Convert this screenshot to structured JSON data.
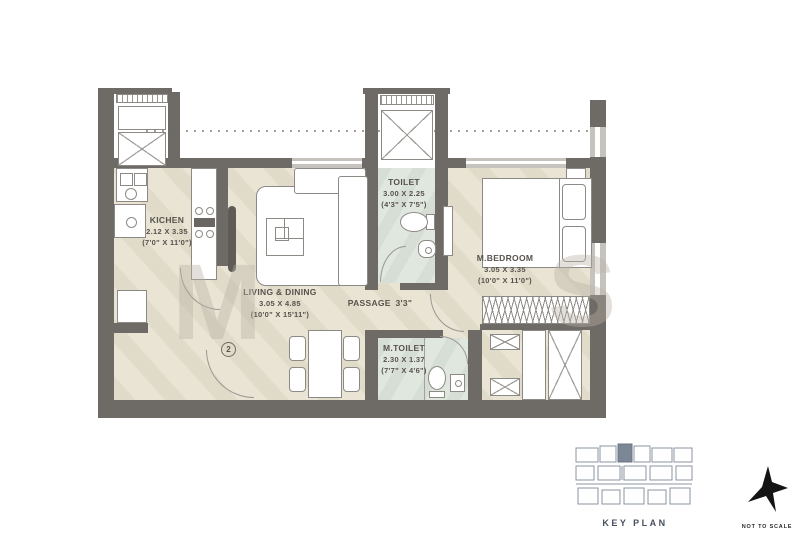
{
  "plan": {
    "rooms": {
      "kitchen": {
        "name": "KICHEN",
        "dims_m": "2.12 X 3.35",
        "dims_ft": "(7'0\" X 11'0\")"
      },
      "living_dining": {
        "name": "LIVING & DINING",
        "dims_m": "3.05 X 4.85",
        "dims_ft": "(10'0\" X 15'11\")"
      },
      "toilet": {
        "name": "TOILET",
        "dims_m": "3.00 X 2.25",
        "dims_ft": "(4'3\" X 7'5\")"
      },
      "master_bedroom": {
        "name": "M.BEDROOM",
        "dims_m": "3.05 X 3.35",
        "dims_ft": "(10'0\" X 11'0\")"
      },
      "master_toilet": {
        "name": "M.TOILET",
        "dims_m": "2.30 X 1.37",
        "dims_ft": "(7'7\" X 4'6\")"
      },
      "passage": {
        "name": "PASSAGE",
        "width": "3'3\""
      }
    },
    "door_marker": "2",
    "watermark_letters": [
      "M",
      "S"
    ]
  },
  "footer": {
    "key_plan": "KEY PLAN",
    "scale_note": "NOT TO SCALE"
  },
  "colors": {
    "wall": "#6e6a66",
    "floor": "#e9e4d4",
    "wet": "#e0e7df",
    "window": "#c6c3bf",
    "line": "#8d8a85",
    "text": "#57524c"
  }
}
